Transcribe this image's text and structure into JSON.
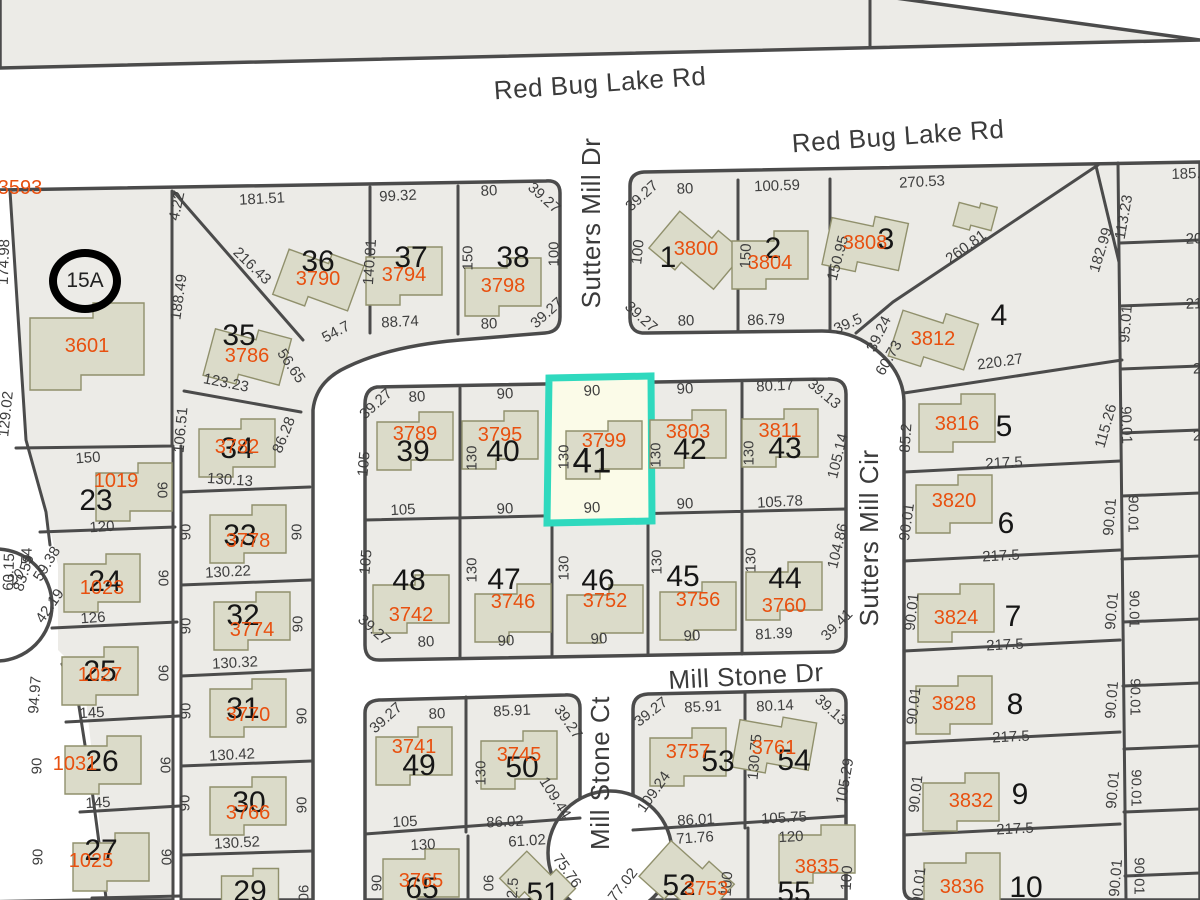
{
  "app": {
    "type": "parcel-map-viewer"
  },
  "colors": {
    "parcel_fill": "#ECEBE7",
    "boundary": "#4B4B4B",
    "building_fill": "#DBDBC9",
    "parcel_id_text": "#E8500F",
    "dimension_text": "#3E3E3E",
    "highlight_stroke": "#2FD9BE",
    "highlight_fill": "#FBFBE8"
  },
  "highlight": {
    "lot": "41",
    "parcel_id": "3799",
    "stroke": "#2FD9BE",
    "fill": "#FBFBE8"
  },
  "special_marker": {
    "label": "15A",
    "x": 85,
    "y": 281
  },
  "streets": [
    {
      "name": "Red Bug Lake Rd",
      "x": 600,
      "y": 83,
      "rot": -4
    },
    {
      "name": "Red Bug Lake Rd",
      "x": 898,
      "y": 136,
      "rot": -4
    },
    {
      "name": "Sutters Mill Dr",
      "x": 591,
      "y": 223,
      "rot": -90
    },
    {
      "name": "Sutters Mill Cir",
      "x": 869,
      "y": 538,
      "rot": -90
    },
    {
      "name": "Mill Stone Dr",
      "x": 746,
      "y": 676,
      "rot": -3
    },
    {
      "name": "Mill Stone Ct",
      "x": 600,
      "y": 773,
      "rot": -90
    }
  ],
  "lots": [
    [
      "36",
      318,
      262
    ],
    [
      "37",
      411,
      258
    ],
    [
      "38",
      513,
      258
    ],
    [
      "35",
      239,
      336
    ],
    [
      "34",
      237,
      449
    ],
    [
      "33",
      240,
      536
    ],
    [
      "32",
      243,
      616
    ],
    [
      "31",
      243,
      709
    ],
    [
      "30",
      249,
      803
    ],
    [
      "29",
      250,
      892
    ],
    [
      "23",
      96,
      501
    ],
    [
      "24",
      105,
      582
    ],
    [
      "25",
      100,
      672
    ],
    [
      "26",
      102,
      762
    ],
    [
      "27",
      101,
      851
    ],
    [
      "39",
      413,
      452
    ],
    [
      "40",
      503,
      452
    ],
    [
      "41",
      592,
      461,
      1
    ],
    [
      "42",
      690,
      450
    ],
    [
      "43",
      785,
      449
    ],
    [
      "48",
      409,
      581
    ],
    [
      "47",
      504,
      580
    ],
    [
      "46",
      598,
      581
    ],
    [
      "45",
      683,
      577
    ],
    [
      "44",
      785,
      579
    ],
    [
      "49",
      419,
      766
    ],
    [
      "50",
      522,
      768
    ],
    [
      "53",
      718,
      762
    ],
    [
      "54",
      794,
      761
    ],
    [
      "65",
      422,
      889
    ],
    [
      "51",
      543,
      894
    ],
    [
      "52",
      679,
      886
    ],
    [
      "55",
      794,
      893
    ],
    [
      "1",
      668,
      258
    ],
    [
      "2",
      773,
      249
    ],
    [
      "3",
      886,
      240
    ],
    [
      "4",
      999,
      316
    ],
    [
      "5",
      1004,
      427
    ],
    [
      "6",
      1006,
      524
    ],
    [
      "7",
      1013,
      617
    ],
    [
      "8",
      1015,
      705
    ],
    [
      "9",
      1020,
      795
    ],
    [
      "10",
      1026,
      888
    ]
  ],
  "parcels": [
    {
      "id": "3593",
      "x": 20,
      "y": 188,
      "b": null
    },
    {
      "id": "3601",
      "x": 87,
      "y": 346,
      "b": 0,
      "s": 1.5
    },
    {
      "id": "3790",
      "x": 318,
      "y": 279,
      "b": 20
    },
    {
      "id": "3794",
      "x": 404,
      "y": 275,
      "b": 0
    },
    {
      "id": "3798",
      "x": 503,
      "y": 286,
      "b": 0
    },
    {
      "id": "3786",
      "x": 247,
      "y": 356,
      "b": 15
    },
    {
      "id": "3782",
      "x": 237,
      "y": 447,
      "b": 0
    },
    {
      "id": "1019",
      "x": 116,
      "y": 481,
      "b": 0,
      "dx": 18,
      "dy": 10
    },
    {
      "id": "1023",
      "x": 102,
      "y": 588,
      "b": 0,
      "dy": -6
    },
    {
      "id": "1027",
      "x": 100,
      "y": 675,
      "b": 0
    },
    {
      "id": "1031",
      "x": 75,
      "y": 764,
      "b": 0,
      "dx": 28
    },
    {
      "id": "1025",
      "x": 91,
      "y": 861,
      "b": 0,
      "dx": 20
    },
    {
      "id": "3778",
      "x": 248,
      "y": 541,
      "b": 0,
      "dy": -8
    },
    {
      "id": "3774",
      "x": 252,
      "y": 630,
      "b": 0,
      "dy": -10
    },
    {
      "id": "3770",
      "x": 248,
      "y": 715,
      "b": 0,
      "dy": -8
    },
    {
      "id": "3766",
      "x": 248,
      "y": 813,
      "b": 0,
      "dy": -8
    },
    {
      "id": "3789",
      "x": 415,
      "y": 434,
      "b": 0,
      "dy": 6
    },
    {
      "id": "3795",
      "x": 500,
      "y": 435,
      "b": 0,
      "dy": 4
    },
    {
      "id": "3799",
      "x": 604,
      "y": 441,
      "b": 0,
      "dy": 8
    },
    {
      "id": "3803",
      "x": 688,
      "y": 432,
      "b": 0,
      "dy": 6
    },
    {
      "id": "3811",
      "x": 780,
      "y": 431,
      "b": 0,
      "dy": 6
    },
    {
      "id": "3742",
      "x": 411,
      "y": 615,
      "b": 0,
      "dy": -12
    },
    {
      "id": "3746",
      "x": 513,
      "y": 602,
      "b": 0,
      "dy": 10
    },
    {
      "id": "3752",
      "x": 605,
      "y": 601,
      "b": 0,
      "dy": 12
    },
    {
      "id": "3756",
      "x": 698,
      "y": 600,
      "b": 0,
      "dy": 10
    },
    {
      "id": "3760",
      "x": 784,
      "y": 606,
      "b": 0,
      "dy": -16
    },
    {
      "id": "3741",
      "x": 414,
      "y": 747,
      "b": 0,
      "dy": 8
    },
    {
      "id": "3745",
      "x": 519,
      "y": 755,
      "b": 0,
      "dy": 4
    },
    {
      "id": "3757",
      "x": 688,
      "y": 752,
      "b": 0,
      "dy": 4
    },
    {
      "id": "3761",
      "x": 774,
      "y": 748,
      "b": 10,
      "dy": -4
    },
    {
      "id": "3765",
      "x": 421,
      "y": 881,
      "b": 0,
      "dy": -4
    },
    {
      "id": "3753",
      "x": 706,
      "y": 889,
      "b": 42,
      "dx": -20,
      "dy": -10
    },
    {
      "id": "3835",
      "x": 817,
      "y": 867,
      "b": 0,
      "dy": -14
    },
    {
      "id": "3800",
      "x": 696,
      "y": 249,
      "b": 40
    },
    {
      "id": "3804",
      "x": 770,
      "y": 263,
      "b": 0,
      "dy": -4
    },
    {
      "id": "3808",
      "x": 865,
      "y": 243,
      "b": 12
    },
    {
      "id": "3812",
      "x": 933,
      "y": 339,
      "b": 18
    },
    {
      "id": "3816",
      "x": 957,
      "y": 424,
      "b": 0,
      "dy": -2
    },
    {
      "id": "3820",
      "x": 954,
      "y": 501,
      "b": 0,
      "dy": 2
    },
    {
      "id": "3824",
      "x": 956,
      "y": 618,
      "b": 0,
      "dy": -6
    },
    {
      "id": "3828",
      "x": 954,
      "y": 704,
      "b": 0
    },
    {
      "id": "3832",
      "x": 971,
      "y": 801,
      "b": 0,
      "dx": -10
    },
    {
      "id": "3836",
      "x": 962,
      "y": 887,
      "b": 0,
      "dy": -6
    },
    {
      "id": "",
      "x": 975,
      "y": 215,
      "b": 15,
      "s": 0.5
    },
    {
      "id": "",
      "x": 537,
      "y": 882,
      "b": 45,
      "s": 0.8
    },
    {
      "id": "",
      "x": 250,
      "y": 889,
      "b": 0,
      "s": 0.75
    }
  ],
  "dims": [
    [
      "181.51",
      262,
      199,
      -3
    ],
    [
      "99.32",
      398,
      196,
      -3
    ],
    [
      "80",
      489,
      191,
      -3
    ],
    [
      "39.27",
      544,
      198,
      42
    ],
    [
      "4.22",
      177,
      206,
      -78
    ],
    [
      "216.43",
      252,
      266,
      44
    ],
    [
      "140.81",
      370,
      262,
      -86
    ],
    [
      "188.49",
      179,
      297,
      -82
    ],
    [
      "174.98",
      4,
      262,
      -88
    ],
    [
      "150",
      468,
      258,
      -90
    ],
    [
      "100",
      554,
      254,
      -90
    ],
    [
      "88.74",
      400,
      322,
      -3
    ],
    [
      "54.7",
      336,
      332,
      -28
    ],
    [
      "80",
      489,
      324,
      -2
    ],
    [
      "39.27",
      547,
      313,
      -42
    ],
    [
      "56.65",
      291,
      366,
      56
    ],
    [
      "123.23",
      226,
      383,
      11
    ],
    [
      "106.51",
      181,
      430,
      -85
    ],
    [
      "86.28",
      284,
      435,
      -68
    ],
    [
      "130.13",
      230,
      480,
      4
    ],
    [
      "129.02",
      6,
      414,
      -84
    ],
    [
      "150",
      88,
      458,
      -4
    ],
    [
      "120",
      102,
      527,
      -4
    ],
    [
      "54",
      27,
      556,
      -88
    ],
    [
      "60.15",
      9,
      572,
      -88
    ],
    [
      "83.59",
      24,
      573,
      -72
    ],
    [
      "59.38",
      47,
      564,
      -58
    ],
    [
      "20",
      16,
      577,
      -40
    ],
    [
      "42.19",
      50,
      606,
      -55
    ],
    [
      "94.97",
      35,
      695,
      -86
    ],
    [
      "126",
      93,
      618,
      -4
    ],
    [
      "145",
      92,
      713,
      -3
    ],
    [
      "145",
      98,
      803,
      -3
    ],
    [
      "90",
      162,
      490,
      90
    ],
    [
      "90",
      163,
      578,
      90
    ],
    [
      "90",
      163,
      673,
      90
    ],
    [
      "90",
      165,
      765,
      90
    ],
    [
      "90",
      166,
      857,
      90
    ],
    [
      "90",
      186,
      532,
      -90
    ],
    [
      "90",
      186,
      626,
      -90
    ],
    [
      "90",
      186,
      711,
      -90
    ],
    [
      "90",
      185,
      803,
      -90
    ],
    [
      "90",
      297,
      532,
      -90
    ],
    [
      "90",
      298,
      624,
      -90
    ],
    [
      "90",
      302,
      716,
      -90
    ],
    [
      "90",
      302,
      805,
      -90
    ],
    [
      "90",
      303,
      893,
      90
    ],
    [
      "90",
      37,
      766,
      -90
    ],
    [
      "90",
      38,
      857,
      -90
    ],
    [
      "130.22",
      228,
      572,
      -3
    ],
    [
      "130.32",
      235,
      663,
      -3
    ],
    [
      "130.42",
      232,
      755,
      -3
    ],
    [
      "130.52",
      237,
      843,
      -3
    ],
    [
      "39.27",
      642,
      196,
      -42
    ],
    [
      "80",
      685,
      189,
      -2
    ],
    [
      "100.59",
      777,
      186,
      -2
    ],
    [
      "270.53",
      922,
      182,
      -3
    ],
    [
      "100",
      638,
      252,
      -84
    ],
    [
      "150",
      746,
      256,
      -88
    ],
    [
      "150.95",
      838,
      258,
      -75
    ],
    [
      "260.81",
      966,
      247,
      -36
    ],
    [
      "113.23",
      1124,
      217,
      -80
    ],
    [
      "182.99",
      1101,
      250,
      -73
    ],
    [
      "39.27",
      641,
      317,
      42
    ],
    [
      "80",
      686,
      321,
      -2
    ],
    [
      "86.79",
      766,
      320,
      -2
    ],
    [
      "39.5",
      848,
      324,
      -24
    ],
    [
      "39.24",
      879,
      334,
      -64
    ],
    [
      "60.73",
      889,
      358,
      -60
    ],
    [
      "220.27",
      1000,
      362,
      -8
    ],
    [
      "95.01",
      1126,
      324,
      -86
    ],
    [
      "85.2",
      906,
      438,
      -86
    ],
    [
      "115.26",
      1106,
      426,
      -74
    ],
    [
      "90.01",
      1126,
      425,
      88
    ],
    [
      "185.",
      1186,
      174,
      -2
    ],
    [
      "20",
      1194,
      239,
      -2
    ],
    [
      "21",
      1194,
      304,
      -2
    ],
    [
      "2",
      1197,
      369,
      -2
    ],
    [
      "2",
      1197,
      436,
      -2
    ],
    [
      "39.27",
      376,
      404,
      -42
    ],
    [
      "80",
      417,
      397,
      -3
    ],
    [
      "90",
      505,
      394,
      -3
    ],
    [
      "90",
      592,
      391,
      -3
    ],
    [
      "90",
      685,
      389,
      -3
    ],
    [
      "80.17",
      775,
      386,
      -3
    ],
    [
      "39.13",
      824,
      394,
      40
    ],
    [
      "105",
      364,
      464,
      -85
    ],
    [
      "105",
      366,
      562,
      -85
    ],
    [
      "130",
      472,
      458,
      -90
    ],
    [
      "130",
      564,
      457,
      -90
    ],
    [
      "130",
      656,
      455,
      -90
    ],
    [
      "130",
      749,
      453,
      -90
    ],
    [
      "105",
      403,
      510,
      -3
    ],
    [
      "90",
      505,
      509,
      -3
    ],
    [
      "90",
      592,
      508,
      -3
    ],
    [
      "90",
      685,
      504,
      -3
    ],
    [
      "105.78",
      780,
      502,
      -3
    ],
    [
      "130",
      472,
      570,
      -90
    ],
    [
      "130",
      564,
      568,
      -90
    ],
    [
      "130",
      657,
      562,
      -90
    ],
    [
      "130",
      751,
      560,
      -90
    ],
    [
      "39.27",
      374,
      630,
      42
    ],
    [
      "80",
      426,
      642,
      -3
    ],
    [
      "90",
      506,
      641,
      -3
    ],
    [
      "90",
      599,
      639,
      -3
    ],
    [
      "90",
      692,
      636,
      -3
    ],
    [
      "81.39",
      774,
      634,
      -3
    ],
    [
      "39.41",
      837,
      625,
      -45
    ],
    [
      "105.14",
      838,
      456,
      -76
    ],
    [
      "104.86",
      838,
      546,
      -76
    ],
    [
      "217.5",
      1004,
      463,
      -3
    ],
    [
      "217.5",
      1001,
      556,
      -3
    ],
    [
      "217.5",
      1005,
      645,
      -3
    ],
    [
      "217.5",
      1011,
      737,
      -3
    ],
    [
      "217.5",
      1015,
      829,
      -3
    ],
    [
      "90.01",
      907,
      522,
      -82
    ],
    [
      "90.01",
      912,
      612,
      -84
    ],
    [
      "90.01",
      914,
      706,
      -84
    ],
    [
      "90.01",
      916,
      794,
      -84
    ],
    [
      "90.01",
      919,
      886,
      -84
    ],
    [
      "90.01",
      1110,
      517,
      -85
    ],
    [
      "90.01",
      1133,
      514,
      90
    ],
    [
      "90.01",
      1112,
      611,
      -85
    ],
    [
      "90.01",
      1134,
      609,
      90
    ],
    [
      "90.01",
      1112,
      700,
      -85
    ],
    [
      "90.01",
      1135,
      697,
      90
    ],
    [
      "90.01",
      1113,
      790,
      -85
    ],
    [
      "90.01",
      1136,
      788,
      90
    ],
    [
      "90.01",
      1116,
      878,
      -85
    ],
    [
      "90.01",
      1139,
      876,
      90
    ],
    [
      "39.27",
      386,
      718,
      -42
    ],
    [
      "80",
      437,
      714,
      -3
    ],
    [
      "85.91",
      512,
      711,
      -3
    ],
    [
      "39.27",
      568,
      722,
      55
    ],
    [
      "39.27",
      651,
      712,
      -38
    ],
    [
      "85.91",
      703,
      707,
      -3
    ],
    [
      "80.14",
      775,
      706,
      -3
    ],
    [
      "39.13",
      831,
      710,
      42
    ],
    [
      "130",
      481,
      773,
      -90
    ],
    [
      "130.75",
      755,
      757,
      -85
    ],
    [
      "109.44",
      555,
      798,
      58
    ],
    [
      "109.24",
      654,
      792,
      -55
    ],
    [
      "86.02",
      505,
      822,
      -3
    ],
    [
      "86.01",
      696,
      820,
      -3
    ],
    [
      "105.75",
      784,
      818,
      -3
    ],
    [
      "105.29",
      845,
      781,
      -80
    ],
    [
      "105",
      405,
      822,
      -3
    ],
    [
      "130",
      423,
      845,
      -3
    ],
    [
      "61.02",
      527,
      841,
      -4
    ],
    [
      "71.76",
      695,
      838,
      -4
    ],
    [
      "120",
      791,
      837,
      -3
    ],
    [
      "75.76",
      567,
      871,
      55
    ],
    [
      "77.02",
      623,
      885,
      -52
    ],
    [
      "100",
      727,
      884,
      -86
    ],
    [
      "100",
      847,
      878,
      -86
    ],
    [
      "2.5",
      513,
      888,
      -86
    ],
    [
      "90",
      377,
      883,
      -90
    ],
    [
      "90",
      488,
      883,
      90
    ]
  ]
}
